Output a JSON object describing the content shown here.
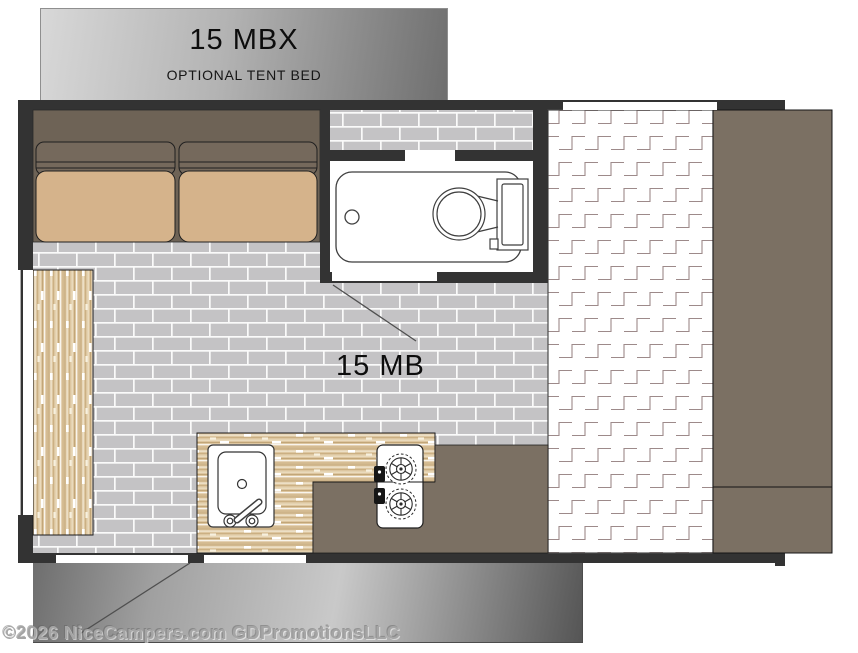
{
  "header": {
    "model": "15 MBX",
    "subtitle": "OPTIONAL TENT BED"
  },
  "plan": {
    "label": "15 MB"
  },
  "watermark": {
    "text": "©2026 NiceCampers.com GDPromotionsLLC"
  },
  "colors": {
    "wall": "#333333",
    "floor_brick": "#c4c3c5",
    "mortar": "#fafafa",
    "sofa_base": "#6e6356",
    "sofa_backrest": "#75695c",
    "sofa_seat": "#d5b38b",
    "bench_wood": "#ddc6a0",
    "cabinet_brown": "#7b7063",
    "mattress_line": "#9d8a8a",
    "bath_fixture": "#ffffff",
    "fixture_outline": "#3f3f3f",
    "leader_line": "#4f4f4f"
  }
}
